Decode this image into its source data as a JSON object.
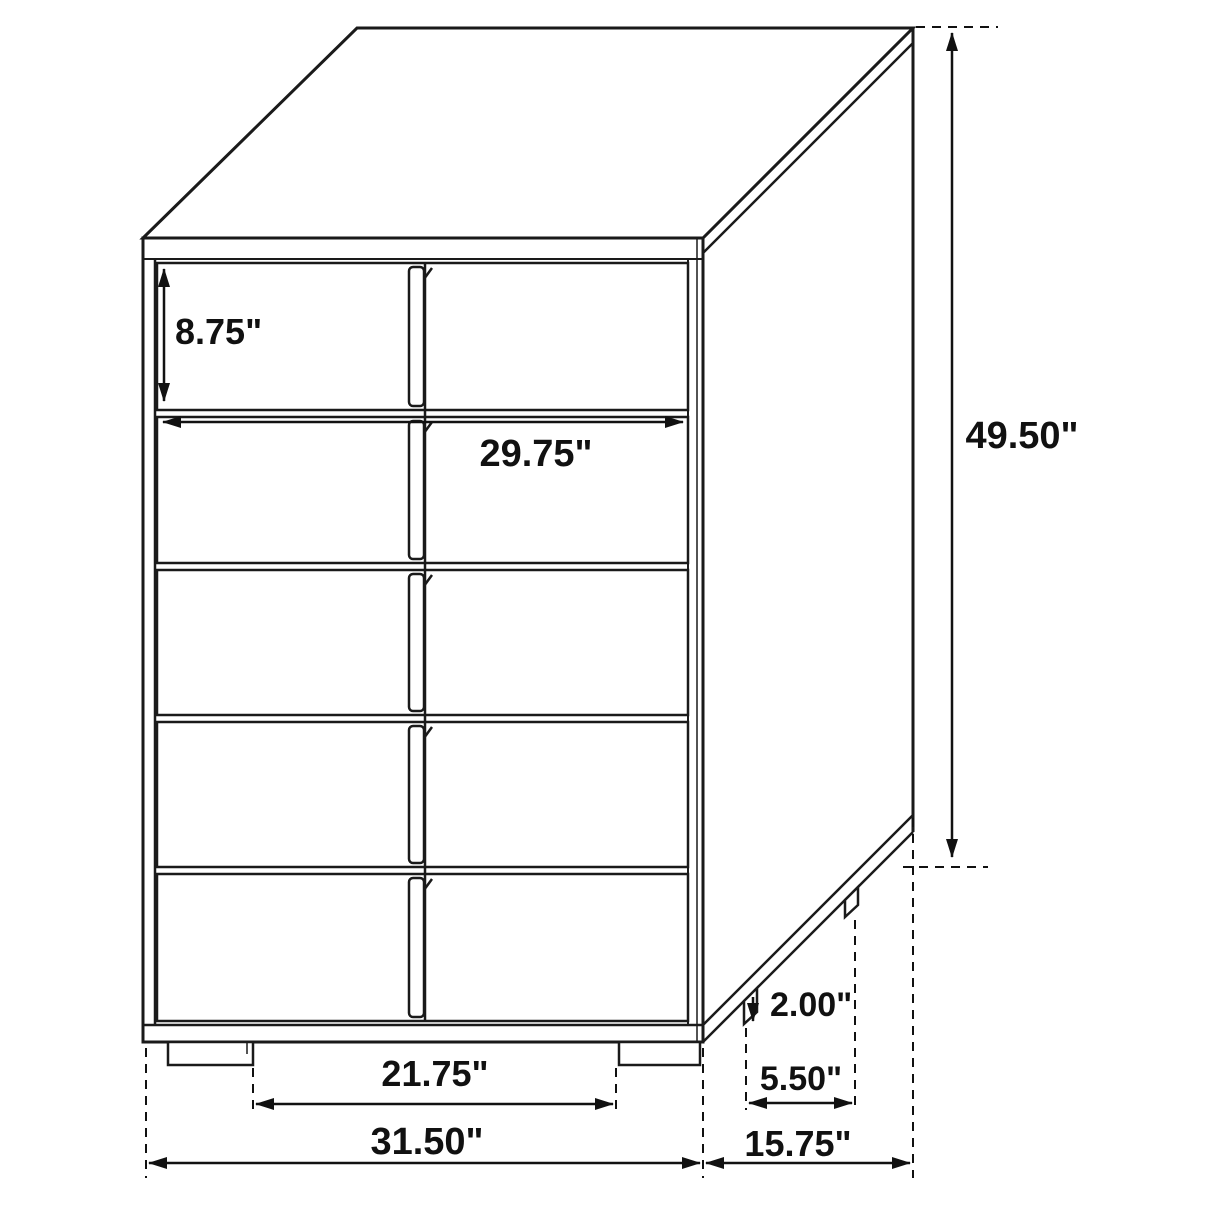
{
  "diagram": {
    "description": "Technical line drawing of a five-drawer chest with dimension annotations",
    "unit": "inches",
    "line_color": "#1a1a1a",
    "background_color": "#ffffff",
    "furniture": {
      "drawer_rows": 5,
      "front_feet": 2,
      "side_feet": 2
    },
    "dimensions": {
      "drawer_height": {
        "label": "8.75\"",
        "value": 8.75
      },
      "drawer_width": {
        "label": "29.75\"",
        "value": 29.75
      },
      "overall_height": {
        "label": "49.50\"",
        "value": 49.5
      },
      "foot_height": {
        "label": "2.00\"",
        "value": 2.0
      },
      "side_foot_spacing": {
        "label": "5.50\"",
        "value": 5.5
      },
      "front_foot_spacing": {
        "label": "21.75\"",
        "value": 21.75
      },
      "overall_width": {
        "label": "31.50\"",
        "value": 31.5
      },
      "overall_depth": {
        "label": "15.75\"",
        "value": 15.75
      }
    }
  }
}
